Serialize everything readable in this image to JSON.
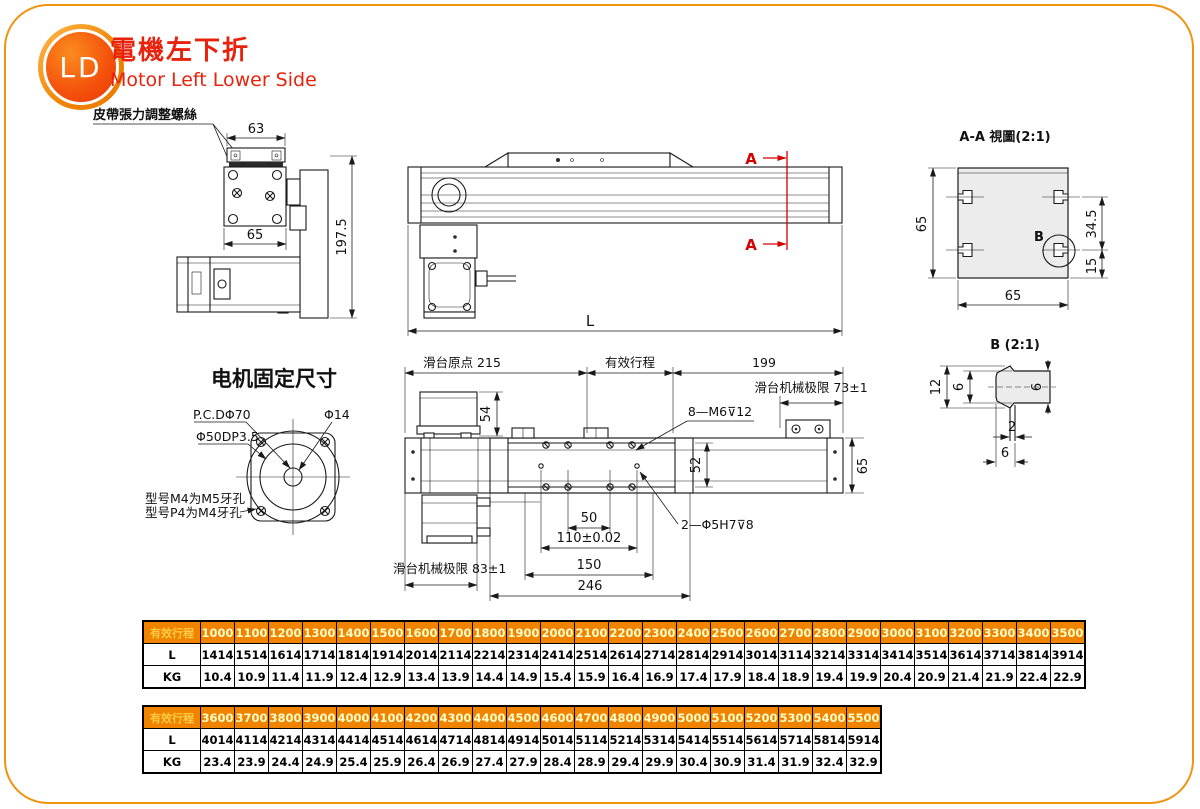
{
  "header": {
    "badge": "LD",
    "title_zh": "電機左下折",
    "title_en": "Motor Left Lower Side"
  },
  "left_view": {
    "belt_label": "皮帶張力調整螺絲",
    "dim_63": "63",
    "dim_65": "65",
    "dim_197": "197.5"
  },
  "side_view": {
    "dim_L": "L",
    "section_a_top": "A",
    "section_a_bottom": "A"
  },
  "aa_view": {
    "title": "A-A 視圖(2:1)",
    "dim_65_left": "65",
    "dim_65_bottom": "65",
    "dim_34": "34.5",
    "dim_15": "15",
    "b_label": "B"
  },
  "b_view": {
    "title": "B (2:1)",
    "dim_12": "12",
    "dim_6_inner": "6",
    "dim_6_right": "6",
    "dim_2": "2",
    "dim_6_bottom": "6"
  },
  "motor_mount": {
    "title": "电机固定尺寸",
    "pcd": "P.C.DΦ70",
    "phi_14": "Φ14",
    "phi_50": "Φ50DP3.5",
    "note_m4": "型号M4为M5牙孔",
    "note_p4": "型号P4为M4牙孔"
  },
  "plan_view": {
    "origin": "滑台原点 215",
    "stroke": "有效行程",
    "dim_199": "199",
    "limit_right": "滑台机械极限 73±1",
    "limit_left": "滑台机械极限 83±1",
    "dim_54": "54",
    "screw_note": "8—M6⊽12",
    "dim_52": "52",
    "dim_65": "65",
    "dim_50": "50",
    "dim_110": "110±0.02",
    "dim_150": "150",
    "dim_246": "246",
    "pin_note": "2—Φ5H7⊽8"
  },
  "tables": [
    {
      "header": "有效行程",
      "strokes": [
        "1000",
        "1100",
        "1200",
        "1300",
        "1400",
        "1500",
        "1600",
        "1700",
        "1800",
        "1900",
        "2000",
        "2100",
        "2200",
        "2300",
        "2400",
        "2500",
        "2600",
        "2700",
        "2800",
        "2900",
        "3000",
        "3100",
        "3200",
        "3300",
        "3400",
        "3500"
      ],
      "rows": [
        {
          "label": "L",
          "values": [
            "1414",
            "1514",
            "1614",
            "1714",
            "1814",
            "1914",
            "2014",
            "2114",
            "2214",
            "2314",
            "2414",
            "2514",
            "2614",
            "2714",
            "2814",
            "2914",
            "3014",
            "3114",
            "3214",
            "3314",
            "3414",
            "3514",
            "3614",
            "3714",
            "3814",
            "3914"
          ]
        },
        {
          "label": "KG",
          "values": [
            "10.4",
            "10.9",
            "11.4",
            "11.9",
            "12.4",
            "12.9",
            "13.4",
            "13.9",
            "14.4",
            "14.9",
            "15.4",
            "15.9",
            "16.4",
            "16.9",
            "17.4",
            "17.9",
            "18.4",
            "18.9",
            "19.4",
            "19.9",
            "20.4",
            "20.9",
            "21.4",
            "21.9",
            "22.4",
            "22.9"
          ]
        }
      ]
    },
    {
      "header": "有效行程",
      "strokes": [
        "3600",
        "3700",
        "3800",
        "3900",
        "4000",
        "4100",
        "4200",
        "4300",
        "4400",
        "4500",
        "4600",
        "4700",
        "4800",
        "4900",
        "5000",
        "5100",
        "5200",
        "5300",
        "5400",
        "5500"
      ],
      "rows": [
        {
          "label": "L",
          "values": [
            "4014",
            "4114",
            "4214",
            "4314",
            "4414",
            "4514",
            "4614",
            "4714",
            "4814",
            "4914",
            "5014",
            "5114",
            "5214",
            "5314",
            "5414",
            "5514",
            "5614",
            "5714",
            "5814",
            "5914"
          ]
        },
        {
          "label": "KG",
          "values": [
            "23.4",
            "23.9",
            "24.4",
            "24.9",
            "25.4",
            "25.9",
            "26.4",
            "26.9",
            "27.4",
            "27.9",
            "28.4",
            "28.9",
            "29.4",
            "29.9",
            "30.4",
            "30.9",
            "31.4",
            "31.9",
            "32.4",
            "32.9"
          ]
        }
      ]
    }
  ]
}
